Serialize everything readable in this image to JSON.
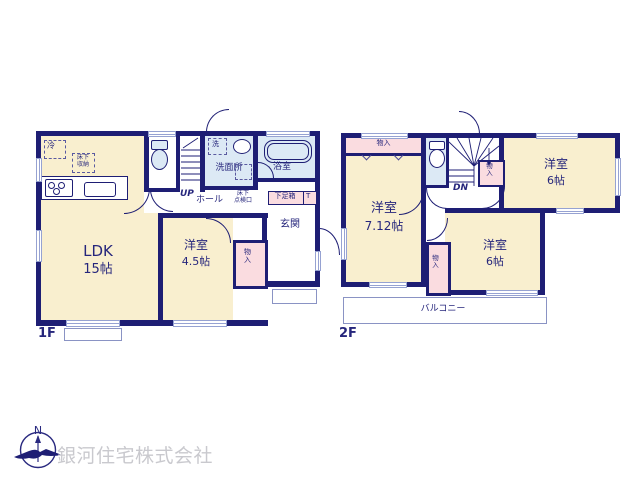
{
  "meta": {
    "floor1_label": "1F",
    "floor2_label": "2F"
  },
  "colors": {
    "wall_navy": "#1e1e74",
    "room_cream": "#f9efcf",
    "wet_blue": "#dce9f5",
    "closet_pink": "#fadce0",
    "window_blue": "#96a2d2",
    "label_navy": "#26267c",
    "company_gray": "#c9c9ce"
  },
  "floor1": {
    "ldk_name": "LDK",
    "ldk_size": "15帖",
    "western_room_name": "洋室",
    "western_room_size": "4.5帖",
    "refrigerator": "冷",
    "underfloor_storage": "床下\n収納",
    "washer": "洗",
    "washroom": "洗面所",
    "bathroom": "浴室",
    "stairs_up": "UP",
    "hall": "ホール",
    "underfloor_hatch": "床下\n点検口",
    "shoe_box": "下足箱",
    "shoe_box_t": "T",
    "entrance": "玄関",
    "closet": "物\n入"
  },
  "floor2": {
    "closet_top": "物入",
    "room_712_name": "洋室",
    "room_712_size": "7.12帖",
    "stairs_down": "DN",
    "closet_mid": "物\n入",
    "room_6a_name": "洋室",
    "room_6a_size": "6帖",
    "closet_bottom": "物\n入",
    "room_6b_name": "洋室",
    "room_6b_size": "6帖",
    "balcony": "バルコニー"
  },
  "footer": {
    "compass_n": "N",
    "company_name": "銀河住宅株式会社"
  }
}
